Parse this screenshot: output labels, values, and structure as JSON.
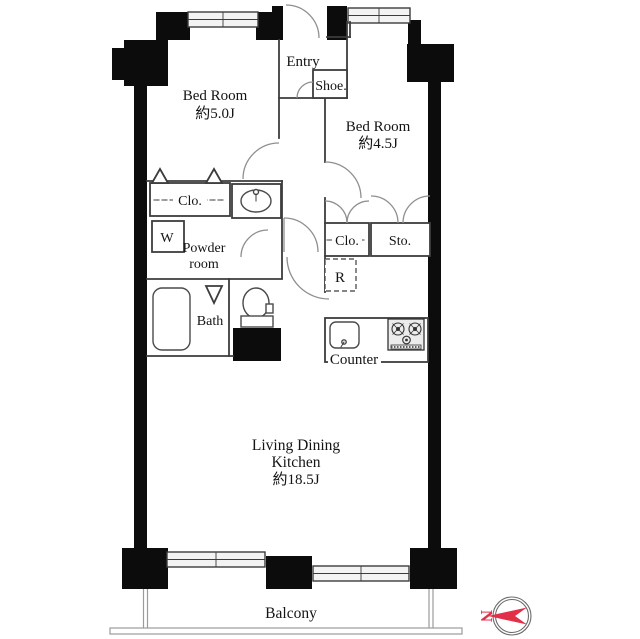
{
  "floorplan": {
    "title": "apartment-floor-plan",
    "rooms": {
      "bedroom1": {
        "name": "Bed Room",
        "size": "約5.0J"
      },
      "bedroom2": {
        "name": "Bed Room",
        "size": "約4.5J"
      },
      "ldk": {
        "line1": "Living Dining",
        "line2": "Kitchen",
        "size": "約18.5J"
      },
      "entry": {
        "name": "Entry"
      },
      "shoe": {
        "name": "Shoe."
      },
      "closet_left": {
        "name": "Clo."
      },
      "closet_right": {
        "name": "Clo."
      },
      "storage": {
        "name": "Sto."
      },
      "powder": {
        "line1": "Powder",
        "line2": "room"
      },
      "bath": {
        "name": "Bath"
      },
      "washer": {
        "name": "W"
      },
      "refrigerator": {
        "name": "R"
      },
      "counter": {
        "name": "Counter"
      },
      "balcony": {
        "name": "Balcony"
      }
    },
    "compass": {
      "label": "N",
      "direction": "left",
      "color": "#e23049"
    },
    "colors": {
      "wall": "#0c0c0c",
      "line": "#3c3c3c",
      "window_fill": "#f3f3f3",
      "door_arc": "#8f8f8f"
    }
  }
}
